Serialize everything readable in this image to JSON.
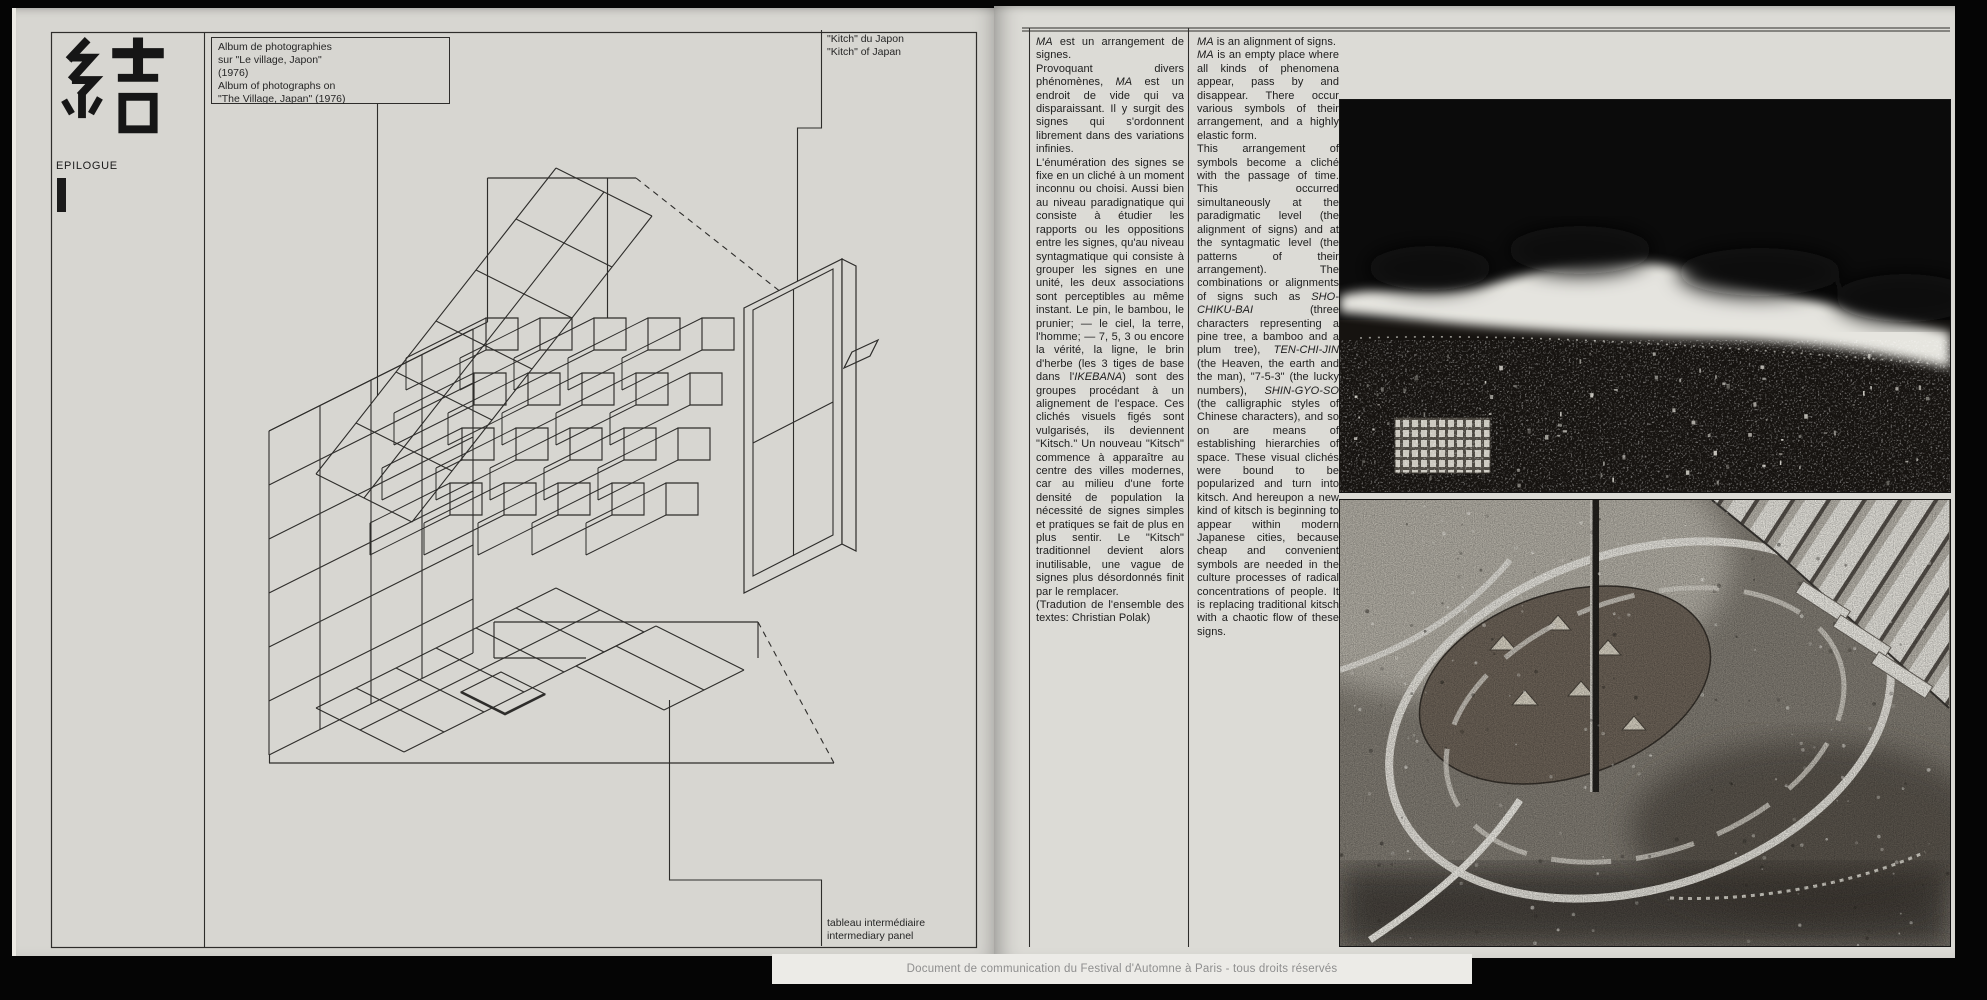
{
  "colors": {
    "paper_left": "#d7d6d1",
    "paper_right": "#dcdbd6",
    "ink": "#1c1c1c",
    "line": "#2e2d2b",
    "watermark_bg": "#ecebe7",
    "watermark_text": "#8e8e8e"
  },
  "left_page": {
    "kanji": "結",
    "epilogue_label": "EPILOGUE",
    "album_caption": "Album de photographies\nsur \"Le village, Japon\"\n(1976)\nAlbum of photographs on\n\"The Village, Japan\" (1976)",
    "kitch_caption": "\"Kitch\" du Japon\n\"Kitch\" of Japan",
    "panel_caption": "tableau intermédiaire\nintermediary panel"
  },
  "right_page": {
    "french_column": {
      "paragraphs": [
        "*MA* est un arrangement de signes.",
        "Provoquant divers phénomènes, *MA* est un endroit de vide qui va disparaissant. Il y surgit des signes qui s'ordonnent librement dans des variations infinies.",
        "L'énumération des signes se fixe en un cliché à un moment inconnu ou choisi. Aussi bien au niveau paradignatique qui consiste à étudier les rapports ou les oppositions entre les signes, qu'au niveau syntagmatique qui consiste à grouper les signes en une unité, les deux associations sont perceptibles au même instant. Le pin, le bambou, le prunier; — le ciel, la terre, l'homme; — 7, 5, 3 ou encore la vérité, la ligne, le brin d'herbe (les 3 tiges de base dans l'*IKEBANA*) sont des groupes procédant à un alignement de l'espace. Ces clichés visuels figés sont vulgarisés, ils deviennent \"Kitsch.\" Un nouveau \"Kitsch\" commence à apparaître au centre des villes modernes, car au milieu d'une forte densité de population la nécessité de signes simples et pratiques se fait de plus en plus sentir. Le \"Kitsch\" traditionnel devient alors inutilisable, une vague de signes plus désordonnés finit par le remplacer.",
        "(Tradution de l'ensemble des textes: Christian Polak)"
      ]
    },
    "english_column": {
      "paragraphs": [
        "*MA* is an alignment of signs.",
        "*MA* is an empty place where all kinds of phenomena appear, pass by and disappear. There occur various symbols of their arrangement, and a highly elastic form.",
        "This arrangement of symbols become a cliché with the passage of time. This occurred simultaneously at the paradigmatic level (the alignment of signs) and at the syntagmatic level (the patterns of their arrangement). The combinations or alignments of signs such as *SHO-CHIKU-BAI* (three characters representing a pine tree, a bamboo and a plum tree), *TEN-CHI-JIN* (the Heaven, the earth and the man), \"7-5-3\" (the lucky numbers), *SHIN-GYO-SO* (the calligraphic styles of Chinese characters), and so on are means of establishing hierarchies of space. These visual clichés were bound to be popularized and turn into kitsch. And hereupon a new kind of kitsch is beginning to appear within modern Japanese cities, because cheap and convenient symbols are needed in the culture processes of radical concentrations of people. It is replacing traditional kitsch with a chaotic flow of these signs.",
        ""
      ]
    },
    "photos": [
      {
        "name": "night-aerial-cityscape-with-cloud-band"
      },
      {
        "name": "festival-plaza-crowd-aerial-night"
      }
    ]
  },
  "watermark": "Document de communication du Festival d'Automne à Paris - tous droits réservés"
}
